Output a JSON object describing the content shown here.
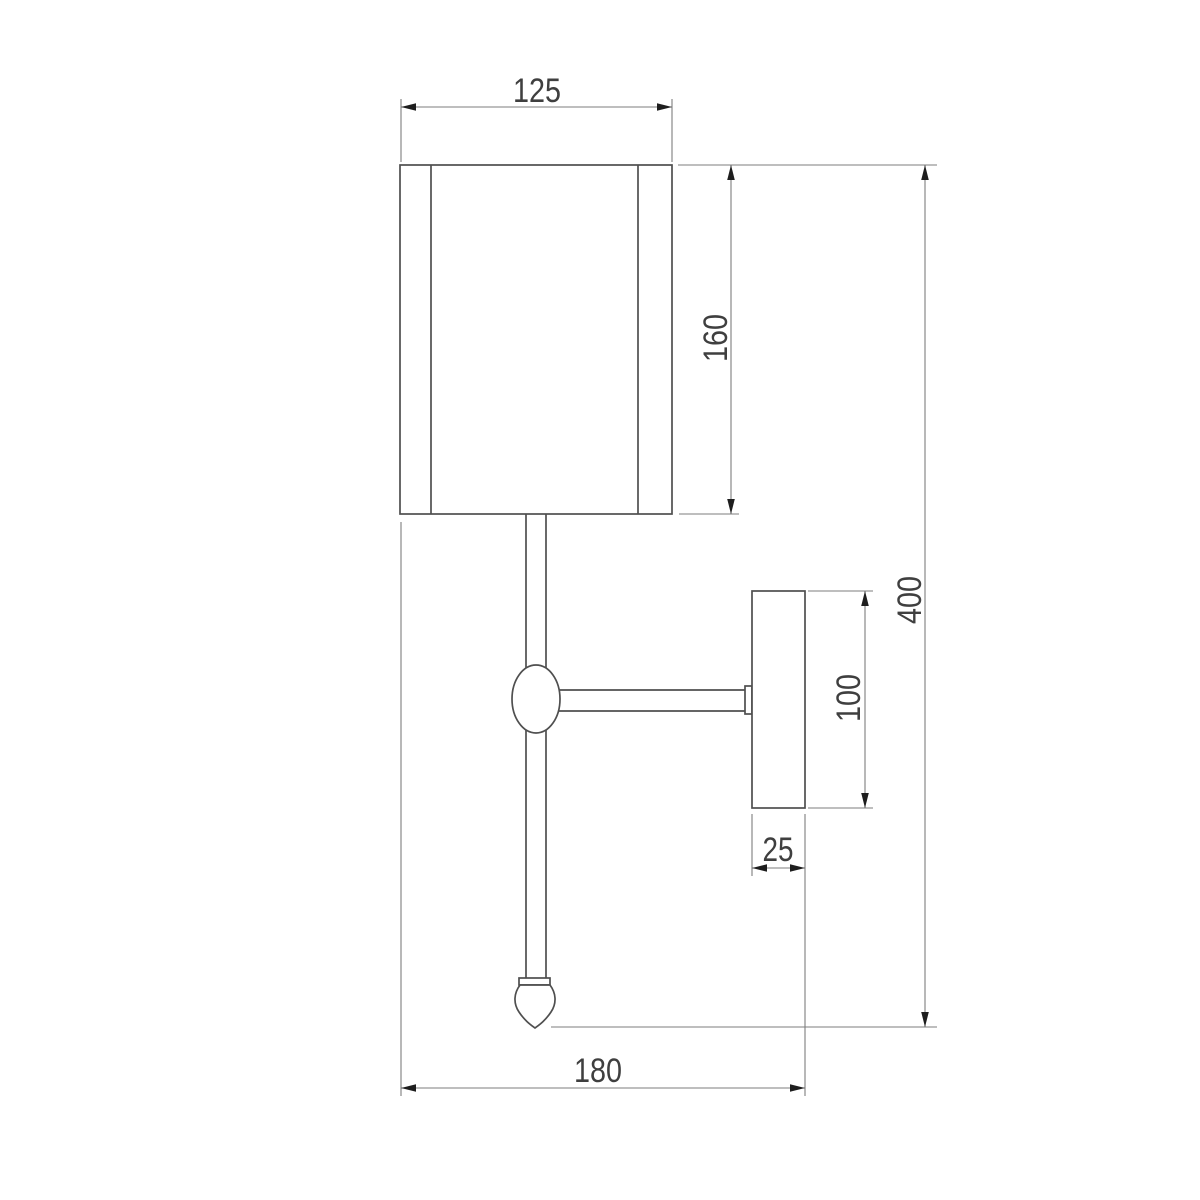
{
  "drawing": {
    "kind": "technical-dimension-drawing",
    "subject": "wall sconce lamp — side elevation",
    "background_color": "#ffffff",
    "object_line_color": "#4f4f4f",
    "dimension_line_color": "#7d7d7d",
    "arrow_color": "#1e1e1e",
    "text_color": "#3f3f3f"
  },
  "dims": {
    "shade_width": "125",
    "shade_height": "160",
    "total_height": "400",
    "plate_height": "100",
    "plate_depth": "25",
    "total_depth": "180"
  },
  "dimensions_mm": {
    "shade_width": 125,
    "shade_height": 160,
    "total_height": 400,
    "backplate_height": 100,
    "backplate_depth": 25,
    "total_depth": 180
  }
}
